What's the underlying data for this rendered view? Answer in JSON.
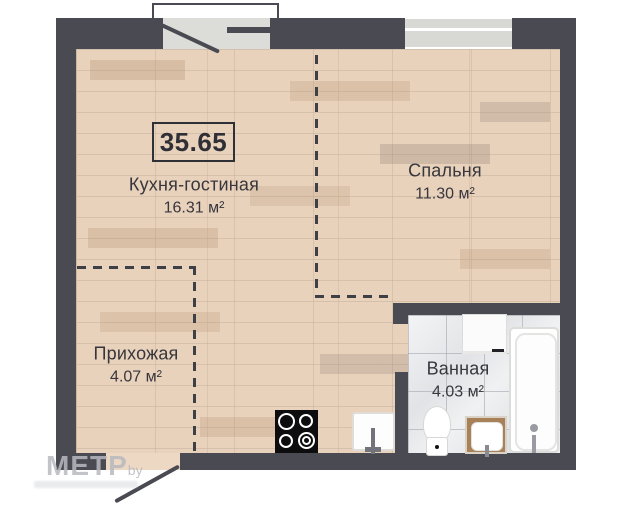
{
  "plan": {
    "total_area_label": "35.65",
    "rooms": [
      {
        "name": "Кухня-гостиная",
        "area": "16.31 м²"
      },
      {
        "name": "Спальня",
        "area": "11.30 м²"
      },
      {
        "name": "Прихожая",
        "area": "4.07 м²"
      },
      {
        "name": "Ванная",
        "area": "4.03 м²"
      }
    ],
    "watermark": {
      "brand": "МЕТР",
      "suffix": "by"
    },
    "colors": {
      "wall": "#4a4a52",
      "wood_floor": "#e9d2bc",
      "tile_floor": "#e7e8ea",
      "label_text": "#36363c",
      "opening_fill": "#dcdcd8"
    },
    "fixtures": [
      "stove",
      "kitchen-sink",
      "washing-machine",
      "bathtub",
      "toilet",
      "vanity-sink"
    ]
  }
}
